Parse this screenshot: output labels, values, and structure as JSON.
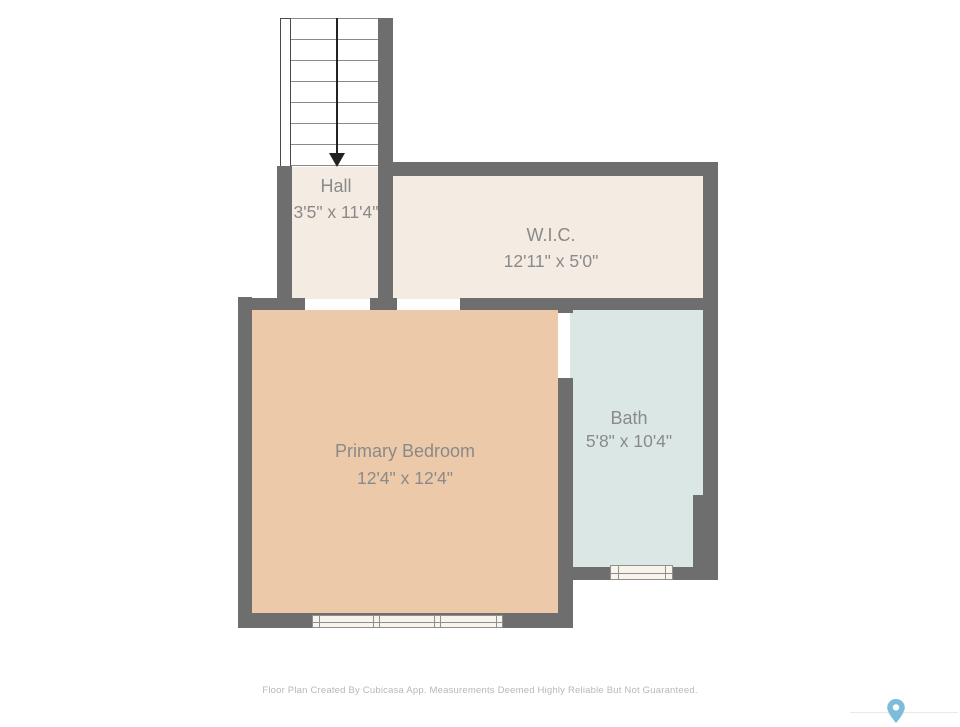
{
  "plan": {
    "stairs": {
      "name": "staircase",
      "direction": "down"
    },
    "rooms": [
      {
        "id": "hall",
        "label": "Hall",
        "dimensions": "3'5\" x 11'4\""
      },
      {
        "id": "wic",
        "label": "W.I.C.",
        "dimensions": "12'11\" x 5'0\""
      },
      {
        "id": "primary_bedroom",
        "label": "Primary Bedroom",
        "dimensions": "12'4\" x 12'4\""
      },
      {
        "id": "bath",
        "label": "Bath",
        "dimensions": "5'8\" x 10'4\""
      }
    ],
    "colors": {
      "wall": "#6e6e6e",
      "hall_floor": "#f4ebe3",
      "wic_floor": "#f4ebe3",
      "bedroom_floor": "#ecc9a8",
      "bath_floor": "#dbe7e5",
      "window_fill": "#f8f4ec",
      "label_text": "#8a8a8a"
    }
  },
  "footer": {
    "disclaimer": "Floor Plan Created By Cubicasa App. Measurements Deemed Highly Reliable But Not Guaranteed."
  },
  "branding": {
    "icon": "location-pin-icon",
    "pin_color": "#7fbcdc"
  }
}
